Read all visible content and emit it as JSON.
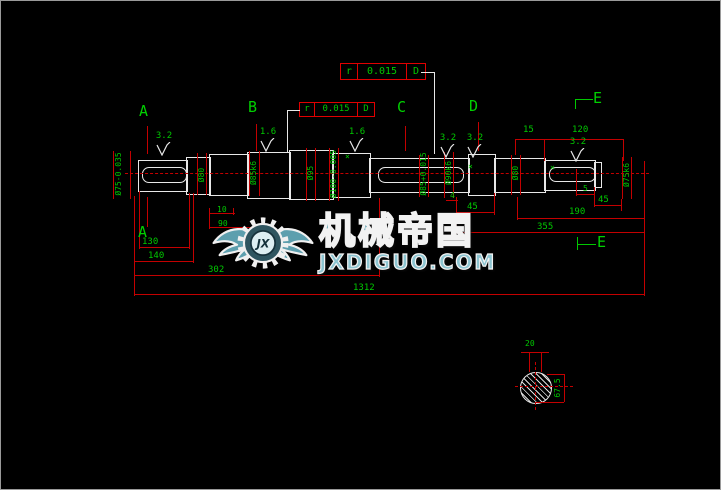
{
  "frames": {
    "upper": {
      "sym": "r",
      "value": "0.015",
      "datum": "D"
    },
    "lower": {
      "sym": "r",
      "value": "0.015",
      "datum": "D"
    }
  },
  "sections": {
    "a_top": "A",
    "b_top": "B",
    "c_top": "C",
    "d_top": "D",
    "e_top": "E",
    "a_bottom": "A",
    "e_bottom": "E"
  },
  "roughness": {
    "r1": "3.2",
    "r2": "1.6",
    "r3": "1.6",
    "r4": "3.2",
    "r5": "3.2",
    "r6": "3.2"
  },
  "dims": {
    "d15": "15",
    "d120": "120",
    "d4": "4",
    "d45a": "45",
    "d5": "5",
    "d45b": "45",
    "d10": "10",
    "d90": "90",
    "d190": "190",
    "d355": "355",
    "d130": "130",
    "d140": "140",
    "d302": "302",
    "total": "1312",
    "key_width": "20",
    "section_depth": "67.5"
  },
  "diameters": {
    "v1": "Ø75-0.035",
    "v2": "Ø80",
    "v3": "Ø85k6",
    "v4": "Ø95",
    "v5": "Ø100-0.005",
    "v6": "Ø85+0.015",
    "v7": "Ø90k6",
    "v8": "Ø80",
    "v9": "Ø75k6"
  },
  "markers": {
    "m1": "×",
    "m2": "×",
    "m3": "×"
  },
  "watermark": {
    "badge": "JX",
    "title": "机械帝国",
    "domain": "JXDIGUO.COM"
  }
}
